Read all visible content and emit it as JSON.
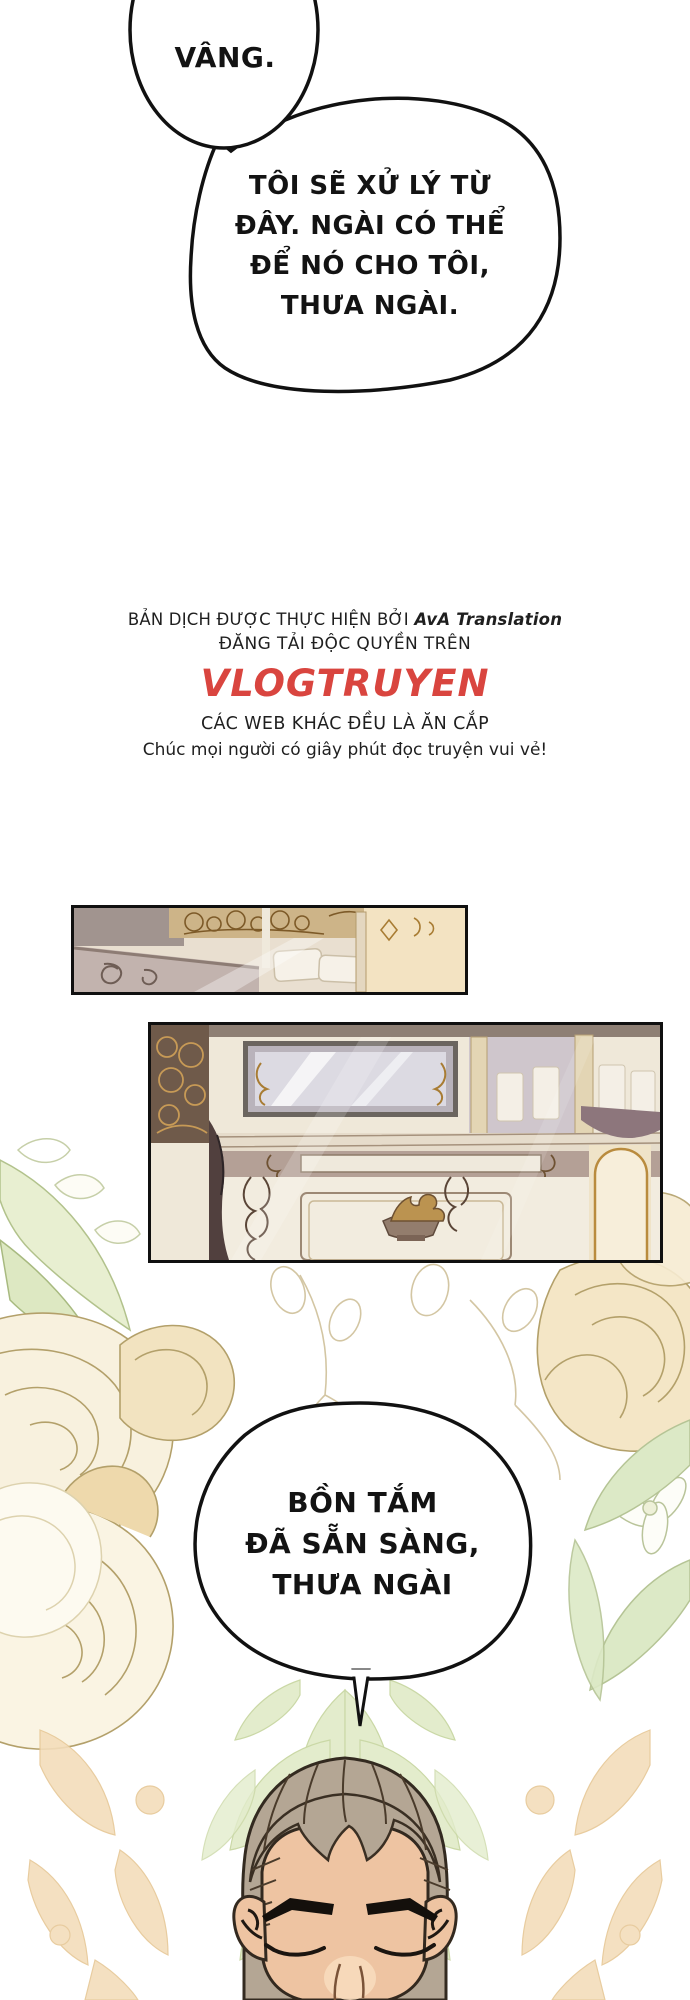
{
  "page": {
    "width": 690,
    "height": 2000,
    "background": "#ffffff"
  },
  "bubbles": {
    "bubble1": {
      "text": "VÂNG."
    },
    "bubble2": {
      "lines": [
        "TÔI SẼ XỬ LÝ TỪ",
        "ĐÂY. NGÀI CÓ THỂ",
        "ĐỂ NÓ CHO TÔI,",
        "THƯA NGÀI."
      ]
    },
    "bubble3": {
      "lines": [
        "BỒN TẮM",
        "ĐÃ SẴN SÀNG,",
        "THƯA NGÀI"
      ]
    }
  },
  "credits": {
    "line1_prefix": "BẢN DỊCH ĐƯỢC THỰC HIỆN BỞI ",
    "line1_brand": "AvA Translation",
    "line2": "ĐĂNG TẢI ĐỘC QUYỀN TRÊN",
    "site_name": "VLOGTRUYEN",
    "line4": "CÁC WEB KHÁC ĐỀU LÀ ĂN CẮP",
    "line5": "Chúc mọi người có giây phút đọc truyện vui vẻ!"
  },
  "colors": {
    "site_red": "#d9453f",
    "ink": "#111111",
    "rose_cream": "#f8f1de",
    "rose_shadow": "#ecd3a4",
    "leaf_green": "#dfe9c4",
    "damask_orange": "#f3ddba"
  }
}
